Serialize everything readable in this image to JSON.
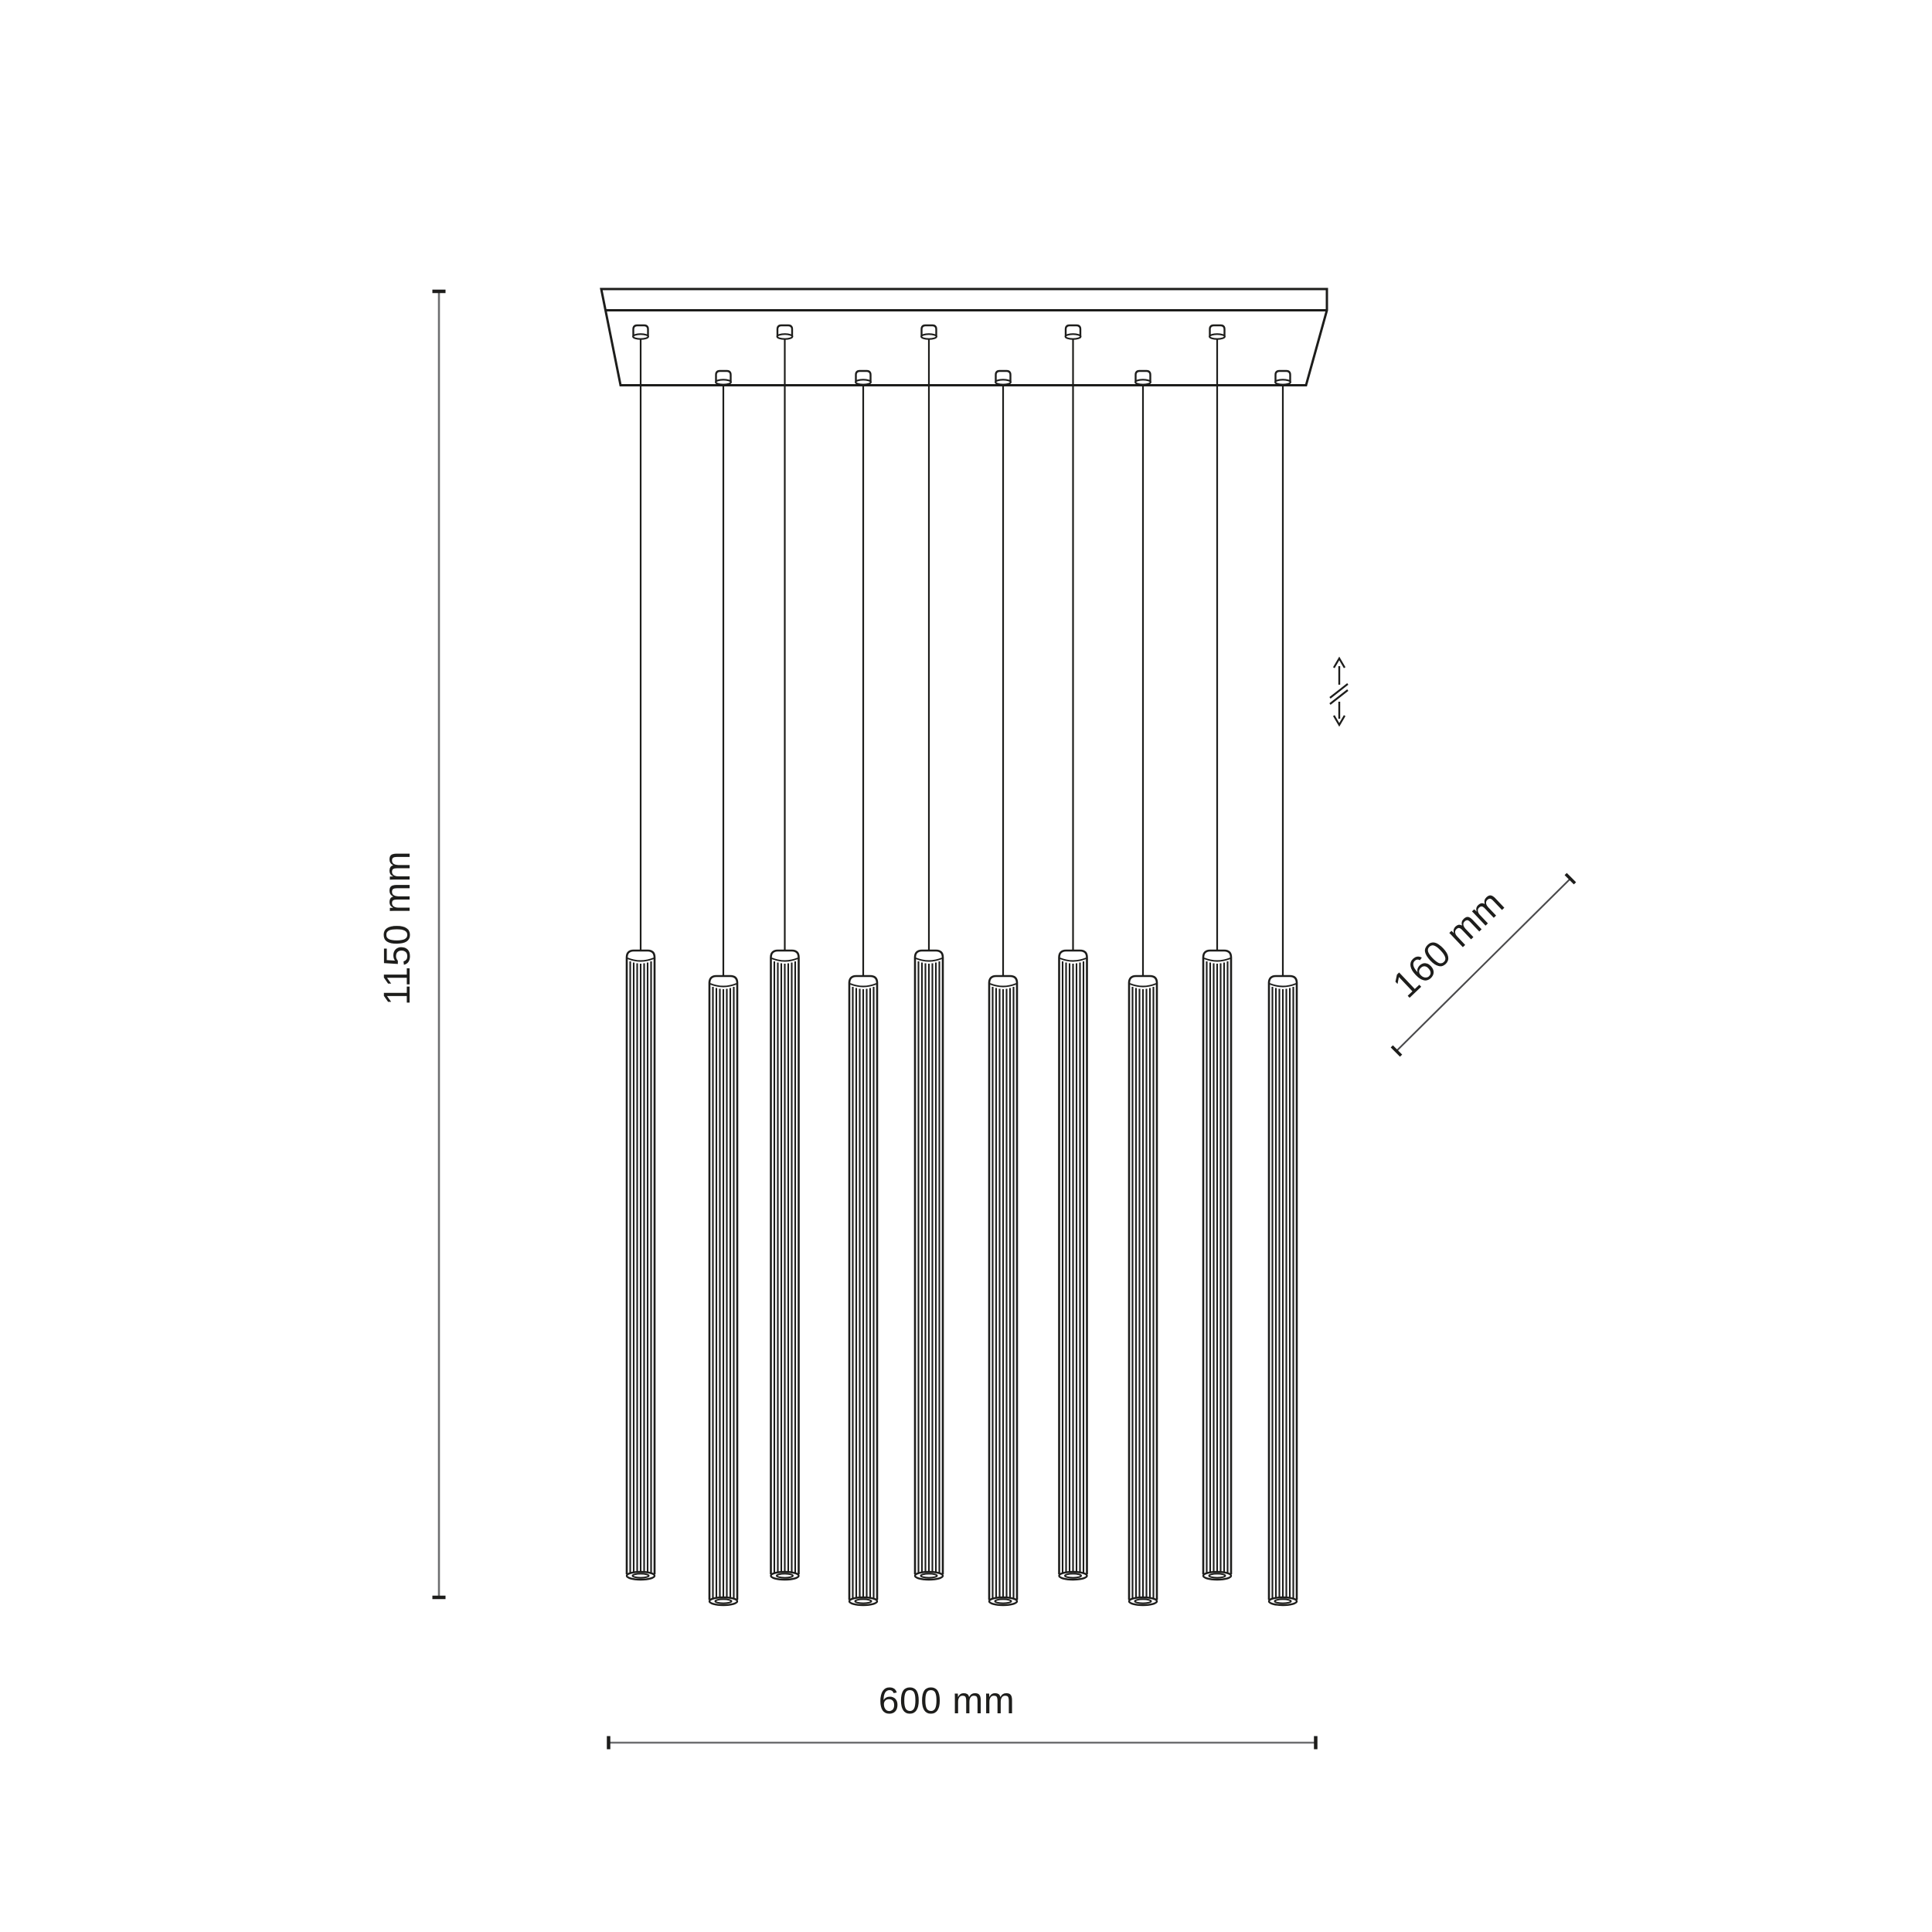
{
  "document": {
    "type": "technical dimension drawing",
    "subject": "linear multi-pendant ceiling lamp with fluted tube shades",
    "background_color": "#ffffff",
    "line_color": "#1d1d1b",
    "dim_line_color": "#6d6e70"
  },
  "fixture": {
    "pendant_count": 10,
    "back_row_count": 5,
    "front_row_count": 5,
    "canopy_shape": "rectangular",
    "icons": [
      "height-adjustable-icon"
    ]
  },
  "dimensions": {
    "height": {
      "label": "1150 mm",
      "value": 1150,
      "unit": "mm",
      "orientation": "vertical"
    },
    "width": {
      "label": "600 mm",
      "value": 600,
      "unit": "mm",
      "orientation": "horizontal"
    },
    "depth": {
      "label": "160 mm",
      "value": 160,
      "unit": "mm",
      "orientation": "diagonal"
    }
  }
}
